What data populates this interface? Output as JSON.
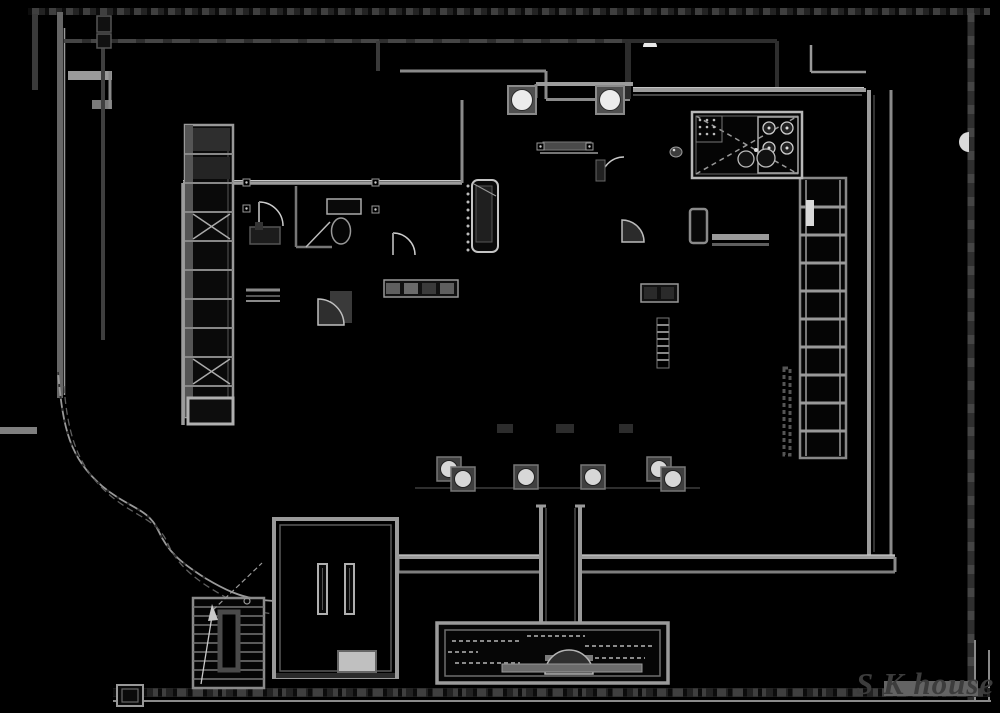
{
  "page": {
    "kind": "cad-floor-plan-drawing",
    "background": "#000000"
  },
  "logo": {
    "text": "S K house",
    "color": "#3c3c3c",
    "underblock_color": "#636363"
  },
  "palette": {
    "site_line_dark": "#2e2e2e",
    "site_line_mid": "#4a4a4a",
    "wall_gray": "#9c9c9c",
    "wall_dark": "#6e6e6e",
    "highlight": "#c9c9c9",
    "fixture_white": "#e8e8e8",
    "fill_black": "#000000"
  },
  "features": [
    {
      "id": "site-boundary",
      "label": "site boundary walls"
    },
    {
      "id": "terrace-retaining-walls",
      "label": "stepped terrace retaining walls"
    },
    {
      "id": "garden-contour-paths",
      "label": "curved garden slope contours"
    },
    {
      "id": "house-walls",
      "label": "main house outline walls"
    },
    {
      "id": "closet-row",
      "label": "left closet / shelving row with cross-braced cells"
    },
    {
      "id": "wardrobe-ladder",
      "label": "right tall shelf ladder"
    },
    {
      "id": "kitchen-counter",
      "label": "kitchen counter with stove and sink"
    },
    {
      "id": "round-columns-top",
      "label": "two round columns on square footings"
    },
    {
      "id": "veranda-columns",
      "label": "row of round veranda column footings"
    },
    {
      "id": "bathroom-fixtures",
      "label": "toilet, shower, vanity, door swings"
    },
    {
      "id": "tokonoma-alcove",
      "label": "vertical alcove element with dotted edge"
    },
    {
      "id": "living-furniture",
      "label": "cabinets, fridge, counters, door swings"
    },
    {
      "id": "entry-hall",
      "label": "entry hall with posts and mat"
    },
    {
      "id": "staircase",
      "label": "switchback staircase with up-arrow"
    },
    {
      "id": "corridor-walls",
      "label": "approach corridor double walls"
    },
    {
      "id": "entrance-gate",
      "label": "entrance gate structure"
    }
  ]
}
